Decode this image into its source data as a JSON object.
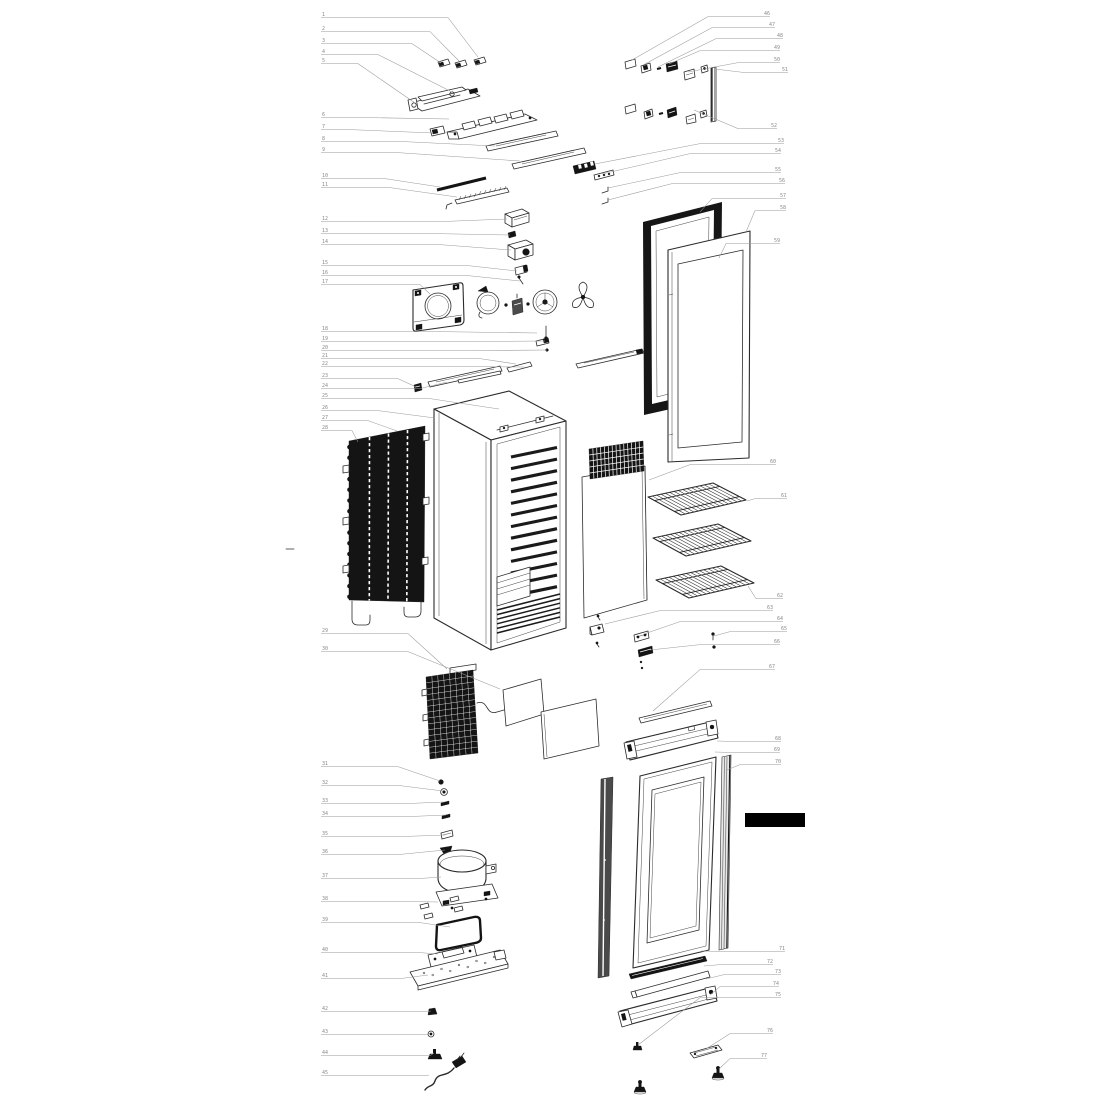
{
  "diagram": {
    "kind": "exploded-parts-diagram",
    "subject": "upright glass-door refrigerator",
    "background_color": "#ffffff",
    "line_color": "#2b2b2b",
    "dark_fill_color": "#141414",
    "black_bar_color": "#000000",
    "callout_line_color": "#9a9a9a",
    "callout_text_color": "#8a8a8a",
    "left_label_x": 321
  },
  "callouts": {
    "left": [
      {
        "n": "1",
        "y": 16,
        "ex": 448,
        "tx": 478,
        "ty": 57
      },
      {
        "n": "2",
        "y": 30,
        "ex": 430,
        "tx": 459,
        "ty": 61
      },
      {
        "n": "3",
        "y": 42,
        "ex": 412,
        "tx": 441,
        "ty": 63
      },
      {
        "n": "4",
        "y": 53,
        "ex": 378,
        "tx": 452,
        "ty": 92
      },
      {
        "n": "5",
        "y": 62,
        "ex": 358,
        "tx": 415,
        "ty": 103
      },
      {
        "n": "6",
        "y": 116,
        "ex": 368,
        "tx": 449,
        "ty": 119
      },
      {
        "n": "7",
        "y": 128,
        "ex": 350,
        "tx": 433,
        "ty": 133
      },
      {
        "n": "8",
        "y": 140,
        "ex": 404,
        "tx": 495,
        "ty": 146
      },
      {
        "n": "9",
        "y": 151,
        "ex": 398,
        "tx": 520,
        "ty": 161
      },
      {
        "n": "10",
        "y": 177,
        "ex": 385,
        "tx": 440,
        "ty": 187
      },
      {
        "n": "11",
        "y": 186,
        "ex": 390,
        "tx": 457,
        "ty": 197
      },
      {
        "n": "12",
        "y": 220,
        "ex": 440,
        "tx": 507,
        "ty": 219
      },
      {
        "n": "13",
        "y": 232,
        "ex": 436,
        "tx": 510,
        "ty": 235
      },
      {
        "n": "14",
        "y": 243,
        "ex": 440,
        "tx": 511,
        "ty": 250
      },
      {
        "n": "15",
        "y": 264,
        "ex": 468,
        "tx": 517,
        "ty": 271
      },
      {
        "n": "16",
        "y": 274,
        "ex": 468,
        "tx": 520,
        "ty": 281
      },
      {
        "n": "17",
        "y": 283,
        "ex": 420,
        "tx": 430,
        "ty": 294
      },
      {
        "n": "18",
        "y": 330,
        "ex": 440,
        "tx": 537,
        "ty": 333
      },
      {
        "n": "19",
        "y": 340,
        "ex": 460,
        "tx": 545,
        "ty": 341
      },
      {
        "n": "20",
        "y": 349,
        "ex": 470,
        "tx": 547,
        "ty": 350
      },
      {
        "n": "21",
        "y": 357,
        "ex": 480,
        "tx": 516,
        "ty": 364
      },
      {
        "n": "22",
        "y": 365,
        "ex": 460,
        "tx": 524,
        "ty": 367
      },
      {
        "n": "23",
        "y": 377,
        "ex": 398,
        "tx": 416,
        "ty": 387
      },
      {
        "n": "24",
        "y": 387,
        "ex": 420,
        "tx": 447,
        "ty": 382
      },
      {
        "n": "25",
        "y": 397,
        "ex": 430,
        "tx": 499,
        "ty": 409
      },
      {
        "n": "26",
        "y": 409,
        "ex": 378,
        "tx": 435,
        "ty": 418
      },
      {
        "n": "27",
        "y": 419,
        "ex": 368,
        "tx": 397,
        "ty": 431
      },
      {
        "n": "28",
        "y": 429,
        "ex": 352,
        "tx": 358,
        "ty": 442
      },
      {
        "n": "29",
        "y": 632,
        "ex": 408,
        "tx": 447,
        "ty": 669
      },
      {
        "n": "30",
        "y": 650,
        "ex": 408,
        "tx": 500,
        "ty": 689
      },
      {
        "n": "31",
        "y": 765,
        "ex": 398,
        "tx": 440,
        "ty": 781
      },
      {
        "n": "32",
        "y": 784,
        "ex": 400,
        "tx": 443,
        "ty": 791
      },
      {
        "n": "33",
        "y": 802,
        "ex": 405,
        "tx": 444,
        "ty": 802
      },
      {
        "n": "34",
        "y": 815,
        "ex": 408,
        "tx": 446,
        "ty": 815
      },
      {
        "n": "35",
        "y": 835,
        "ex": 400,
        "tx": 445,
        "ty": 835
      },
      {
        "n": "36",
        "y": 853,
        "ex": 398,
        "tx": 445,
        "ty": 850
      },
      {
        "n": "37",
        "y": 877,
        "ex": 418,
        "tx": 441,
        "ty": 877
      },
      {
        "n": "38",
        "y": 900,
        "ex": 418,
        "tx": 438,
        "ty": 902
      },
      {
        "n": "39",
        "y": 921,
        "ex": 420,
        "tx": 450,
        "ty": 927
      },
      {
        "n": "40",
        "y": 951,
        "ex": 420,
        "tx": 438,
        "ty": 954
      },
      {
        "n": "41",
        "y": 977,
        "ex": 400,
        "tx": 428,
        "ty": 975
      },
      {
        "n": "42",
        "y": 1010,
        "ex": 426,
        "tx": 431,
        "ty": 1011
      },
      {
        "n": "43",
        "y": 1033,
        "ex": 428,
        "tx": 430,
        "ty": 1033
      },
      {
        "n": "44",
        "y": 1054,
        "ex": 430,
        "tx": 434,
        "ty": 1053
      },
      {
        "n": "45",
        "y": 1074,
        "ex": 426,
        "tx": 429,
        "ty": 1075
      }
    ],
    "right": [
      {
        "n": "46",
        "x": 770,
        "y": 15,
        "ex": 708,
        "tx": 632,
        "ty": 60
      },
      {
        "n": "47",
        "x": 775,
        "y": 26,
        "ex": 712,
        "tx": 645,
        "ty": 64
      },
      {
        "n": "48",
        "x": 783,
        "y": 37,
        "ex": 716,
        "tx": 658,
        "ty": 67
      },
      {
        "n": "49",
        "x": 780,
        "y": 49,
        "ex": 700,
        "tx": 669,
        "ty": 64
      },
      {
        "n": "50",
        "x": 780,
        "y": 61,
        "ex": 738,
        "tx": 688,
        "ty": 72
      },
      {
        "n": "51",
        "x": 788,
        "y": 71,
        "ex": 745,
        "tx": 715,
        "ty": 69
      },
      {
        "n": "52",
        "x": 777,
        "y": 127,
        "ex": 738,
        "tx": 694,
        "ty": 110
      },
      {
        "n": "53",
        "x": 784,
        "y": 142,
        "ex": 700,
        "tx": 595,
        "ty": 164
      },
      {
        "n": "54",
        "x": 781,
        "y": 152,
        "ex": 690,
        "tx": 602,
        "ty": 174
      },
      {
        "n": "55",
        "x": 781,
        "y": 171,
        "ex": 680,
        "tx": 608,
        "ty": 188
      },
      {
        "n": "56",
        "x": 785,
        "y": 182,
        "ex": 672,
        "tx": 608,
        "ty": 200
      },
      {
        "n": "57",
        "x": 786,
        "y": 197,
        "ex": 712,
        "tx": 700,
        "ty": 212
      },
      {
        "n": "58",
        "x": 786,
        "y": 209,
        "ex": 755,
        "tx": 746,
        "ty": 232
      },
      {
        "n": "59",
        "x": 780,
        "y": 242,
        "ex": 726,
        "tx": 719,
        "ty": 258
      },
      {
        "n": "60",
        "x": 776,
        "y": 463,
        "ex": 690,
        "tx": 649,
        "ty": 480
      },
      {
        "n": "61",
        "x": 787,
        "y": 497,
        "ex": 755,
        "tx": 747,
        "ty": 501
      },
      {
        "n": "62",
        "x": 783,
        "y": 597,
        "ex": 756,
        "tx": 748,
        "ty": 586
      },
      {
        "n": "63",
        "x": 773,
        "y": 609,
        "ex": 660,
        "tx": 605,
        "ty": 624
      },
      {
        "n": "64",
        "x": 783,
        "y": 620,
        "ex": 680,
        "tx": 644,
        "ty": 634
      },
      {
        "n": "65",
        "x": 787,
        "y": 630,
        "ex": 730,
        "tx": 714,
        "ty": 636
      },
      {
        "n": "66",
        "x": 780,
        "y": 643,
        "ex": 700,
        "tx": 650,
        "ty": 650
      },
      {
        "n": "67",
        "x": 775,
        "y": 668,
        "ex": 700,
        "tx": 653,
        "ty": 711
      },
      {
        "n": "68",
        "x": 781,
        "y": 740,
        "ex": 740,
        "tx": 717,
        "ty": 741
      },
      {
        "n": "69",
        "x": 780,
        "y": 751,
        "ex": 736,
        "tx": 715,
        "ty": 752
      },
      {
        "n": "70",
        "x": 781,
        "y": 763,
        "ex": 740,
        "tx": 727,
        "ty": 770
      },
      {
        "n": "71",
        "x": 785,
        "y": 950,
        "ex": 730,
        "tx": 701,
        "ty": 951
      },
      {
        "n": "72",
        "x": 773,
        "y": 963,
        "ex": 720,
        "tx": 704,
        "ty": 966
      },
      {
        "n": "73",
        "x": 781,
        "y": 973,
        "ex": 724,
        "tx": 706,
        "ty": 979
      },
      {
        "n": "74",
        "x": 779,
        "y": 985,
        "ex": 720,
        "tx": 710,
        "ty": 995
      },
      {
        "n": "75",
        "x": 781,
        "y": 996,
        "ex": 700,
        "tx": 638,
        "ty": 1045
      },
      {
        "n": "76",
        "x": 773,
        "y": 1032,
        "ex": 730,
        "tx": 706,
        "ty": 1049
      },
      {
        "n": "77",
        "x": 767,
        "y": 1057,
        "ex": 730,
        "tx": 719,
        "ty": 1069
      }
    ]
  }
}
